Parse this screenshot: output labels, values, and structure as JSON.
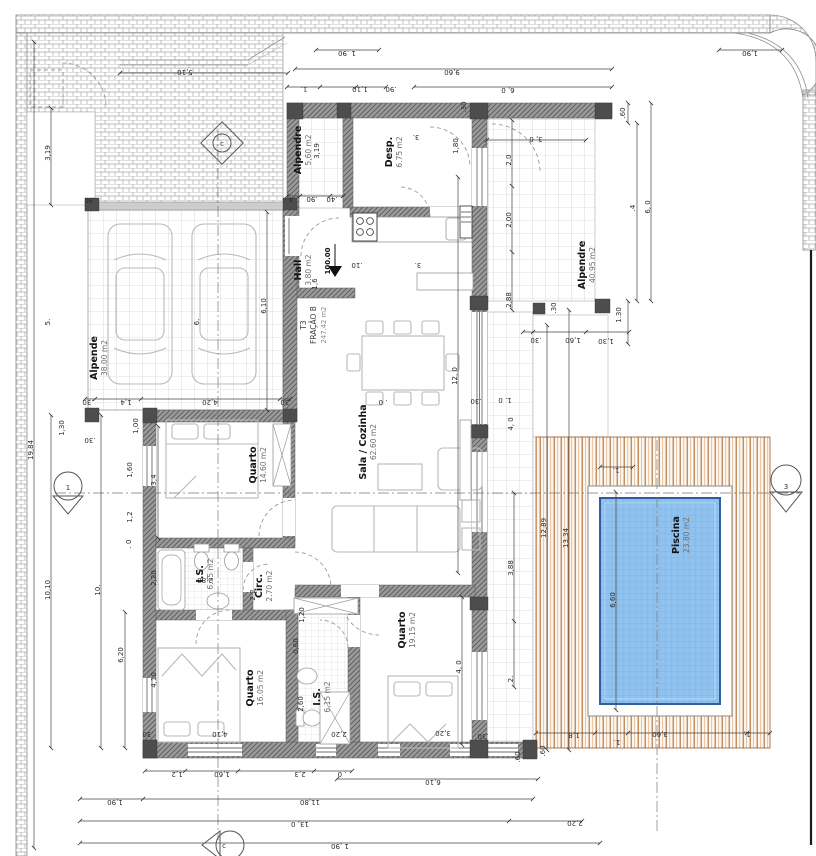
{
  "drawing": {
    "fraction": {
      "line1": "T3",
      "line2": "FRAÇÃO B",
      "line3": "247.42 m2",
      "x": 306,
      "y": 325
    },
    "level_marker": {
      "t": "100.00",
      "x": 330,
      "y": 261
    },
    "colors": {
      "wall": "#9b9b9b",
      "column": "#4d4d4d",
      "deck_stripe": "#b06a33",
      "pool_water": "#8fc2ee",
      "pool_border": "#2f5d9e",
      "tile_line": "#c2c2c2",
      "brick_line": "#a8a8a8"
    }
  },
  "rooms": [
    {
      "name": "Alpende",
      "area": "38.00 m2",
      "x": 97,
      "y": 358,
      "r": -90
    },
    {
      "name": "Alpendre",
      "area": "5,60 m2",
      "x": 301,
      "y": 150,
      "r": -90
    },
    {
      "name": "Desp.",
      "area": "6.75 m2",
      "x": 392,
      "y": 152,
      "r": -90
    },
    {
      "name": "Hall",
      "area": "3.80 m2",
      "x": 301,
      "y": 270,
      "r": -90
    },
    {
      "name": "Sala / Cozinha",
      "area": "62.60 m2",
      "x": 366,
      "y": 442,
      "r": -90
    },
    {
      "name": "Quarto",
      "area": "14.60 m2",
      "x": 256,
      "y": 465,
      "r": -90
    },
    {
      "name": "I.S.",
      "area": "6.15 m2",
      "x": 203,
      "y": 574,
      "r": -90
    },
    {
      "name": "Circ.",
      "area": "2.70 m2",
      "x": 262,
      "y": 586,
      "r": -90
    },
    {
      "name": "Quarto",
      "area": "16.05 m2",
      "x": 253,
      "y": 688,
      "r": -90
    },
    {
      "name": "I.S.",
      "area": "6,15 m2",
      "x": 320,
      "y": 697,
      "r": -90
    },
    {
      "name": "Quarto",
      "area": "19.15 m2",
      "x": 405,
      "y": 630,
      "r": -90
    },
    {
      "name": "Alpendre",
      "area": "40.95 m2",
      "x": 585,
      "y": 265,
      "r": -90
    },
    {
      "name": "Piscina",
      "area": "23.80 m2",
      "x": 679,
      "y": 535,
      "r": -90
    }
  ],
  "marker_letters": [
    {
      "t": "c",
      "x": 222,
      "y": 146
    },
    {
      "t": "1",
      "x": 68,
      "y": 490
    },
    {
      "t": "3",
      "x": 786,
      "y": 489
    },
    {
      "t": "c",
      "x": 224,
      "y": 848
    }
  ],
  "dims": [
    {
      "t": "5,10",
      "x": 185,
      "y": 70,
      "r": 180
    },
    {
      "t": "1 .90",
      "x": 347,
      "y": 51,
      "r": 180
    },
    {
      "t": "1,90",
      "x": 750,
      "y": 51,
      "r": 180
    },
    {
      "t": "9,60",
      "x": 452,
      "y": 70,
      "r": 180
    },
    {
      "t": "6, 0",
      "x": 508,
      "y": 88,
      "r": 180
    },
    {
      "t": "1.",
      "x": 304,
      "y": 87,
      "r": 180
    },
    {
      "t": "1,10",
      "x": 360,
      "y": 87,
      "r": 180
    },
    {
      "t": ".90",
      "x": 391,
      "y": 87,
      "r": 180
    },
    {
      "t": "19,84",
      "x": 33,
      "y": 450,
      "r": -90
    },
    {
      "t": "3,19",
      "x": 50,
      "y": 153,
      "r": -90
    },
    {
      "t": "5.",
      "x": 50,
      "y": 322,
      "r": -90
    },
    {
      "t": "6.",
      "x": 199,
      "y": 322,
      "r": -90
    },
    {
      "t": "10,10",
      "x": 50,
      "y": 590,
      "r": -90
    },
    {
      "t": "10.",
      "x": 100,
      "y": 590,
      "r": -90
    },
    {
      "t": "6,20",
      "x": 123,
      "y": 655,
      "r": -90
    },
    {
      "t": "1,30",
      "x": 64,
      "y": 428,
      "r": -90
    },
    {
      "t": "1,00",
      "x": 138,
      "y": 426,
      "r": -90
    },
    {
      "t": "1,60",
      "x": 132,
      "y": 470,
      "r": -90
    },
    {
      "t": "1,2",
      "x": 132,
      "y": 517,
      "r": -90
    },
    {
      "t": ". 0",
      "x": 131,
      "y": 544,
      "r": -90
    },
    {
      "t": "3,4",
      "x": 156,
      "y": 480,
      "r": -90
    },
    {
      "t": "2,20",
      "x": 156,
      "y": 578,
      "r": -90
    },
    {
      "t": "4,10",
      "x": 156,
      "y": 680,
      "r": -90
    },
    {
      "t": ".30",
      "x": 90,
      "y": 198,
      "r": 180
    },
    {
      "t": "6,10",
      "x": 266,
      "y": 306,
      "r": -90
    },
    {
      "t": ".30",
      "x": 88,
      "y": 400,
      "r": 180
    },
    {
      "t": "1,4",
      "x": 126,
      "y": 400,
      "r": 180
    },
    {
      "t": "4,20",
      "x": 210,
      "y": 400,
      "r": 180
    },
    {
      "t": ".30",
      "x": 286,
      "y": 400,
      "r": 180
    },
    {
      "t": ".30",
      "x": 90,
      "y": 438,
      "r": 180
    },
    {
      "t": ".4",
      "x": 292,
      "y": 197,
      "r": 180
    },
    {
      "t": ".90",
      "x": 312,
      "y": 197,
      "r": 180
    },
    {
      "t": ".40",
      "x": 332,
      "y": 197,
      "r": 180
    },
    {
      "t": "3,19",
      "x": 319,
      "y": 151,
      "r": -90
    },
    {
      "t": "1,80",
      "x": 458,
      "y": 146,
      "r": -90
    },
    {
      "t": "3.",
      "x": 416,
      "y": 135,
      "r": 180
    },
    {
      "t": "3.",
      "x": 418,
      "y": 263,
      "r": 180
    },
    {
      "t": ".10",
      "x": 357,
      "y": 263,
      "r": 180
    },
    {
      "t": "1,6",
      "x": 317,
      "y": 284,
      "r": -90
    },
    {
      "t": ".60",
      "x": 625,
      "y": 113,
      "r": -90
    },
    {
      "t": "3, 0",
      "x": 536,
      "y": 137,
      "r": 180
    },
    {
      "t": ".30",
      "x": 466,
      "y": 107,
      "r": -90
    },
    {
      "t": "2,0",
      "x": 511,
      "y": 160,
      "r": -90
    },
    {
      "t": "2,00",
      "x": 511,
      "y": 220,
      "r": -90
    },
    {
      "t": "2,88",
      "x": 511,
      "y": 300,
      "r": -90
    },
    {
      "t": ".4",
      "x": 635,
      "y": 208,
      "r": -90
    },
    {
      "t": "6, 0",
      "x": 650,
      "y": 207,
      "r": -90
    },
    {
      "t": "1.30",
      "x": 621,
      "y": 315,
      "r": -90
    },
    {
      "t": ".30",
      "x": 536,
      "y": 338,
      "r": 180
    },
    {
      "t": "1,60",
      "x": 573,
      "y": 338,
      "r": 180
    },
    {
      "t": "1,30",
      "x": 606,
      "y": 339,
      "r": 180
    },
    {
      "t": ".30",
      "x": 556,
      "y": 308,
      "r": -90
    },
    {
      "t": "12, 0",
      "x": 457,
      "y": 376,
      "r": -90
    },
    {
      "t": ". 0",
      "x": 383,
      "y": 400,
      "r": 180
    },
    {
      "t": ".30",
      "x": 476,
      "y": 399,
      "r": 180
    },
    {
      "t": "1. 0",
      "x": 505,
      "y": 398,
      "r": 180
    },
    {
      "t": "4, 0",
      "x": 513,
      "y": 424,
      "r": -90
    },
    {
      "t": "2,80",
      "x": 205,
      "y": 578,
      "r": 180
    },
    {
      "t": "1,20",
      "x": 304,
      "y": 615,
      "r": -90
    },
    {
      "t": "0,60",
      "x": 298,
      "y": 646,
      "r": -90
    },
    {
      "t": "2,2",
      "x": 255,
      "y": 595,
      "r": -90
    },
    {
      "t": "2,60",
      "x": 303,
      "y": 704,
      "r": -90
    },
    {
      "t": "2,20",
      "x": 339,
      "y": 732,
      "r": 180
    },
    {
      "t": "3,20",
      "x": 443,
      "y": 731,
      "r": 180
    },
    {
      "t": ".30",
      "x": 148,
      "y": 732,
      "r": 180
    },
    {
      "t": "4,10",
      "x": 220,
      "y": 732,
      "r": 180
    },
    {
      "t": ".30",
      "x": 483,
      "y": 734,
      "r": 180
    },
    {
      "t": "4, 0",
      "x": 461,
      "y": 667,
      "r": -90
    },
    {
      "t": "12,89",
      "x": 546,
      "y": 528,
      "r": -90
    },
    {
      "t": "13,34",
      "x": 568,
      "y": 538,
      "r": -90
    },
    {
      "t": "3,88",
      "x": 513,
      "y": 568,
      "r": -90
    },
    {
      "t": "6,60",
      "x": 615,
      "y": 600,
      "r": -90
    },
    {
      "t": "2.",
      "x": 513,
      "y": 679,
      "r": -90
    },
    {
      "t": "1.",
      "x": 616,
      "y": 468,
      "r": 180
    },
    {
      "t": ".60",
      "x": 520,
      "y": 757,
      "r": -90
    },
    {
      "t": ".60",
      "x": 545,
      "y": 751,
      "r": -90
    },
    {
      "t": "1,8",
      "x": 574,
      "y": 733,
      "r": 180
    },
    {
      "t": "1.",
      "x": 617,
      "y": 740,
      "r": 180
    },
    {
      "t": "3,60",
      "x": 660,
      "y": 732,
      "r": 180
    },
    {
      "t": "1,",
      "x": 747,
      "y": 732,
      "r": 180
    },
    {
      "t": "1,2",
      "x": 177,
      "y": 772,
      "r": 180
    },
    {
      "t": "1,60",
      "x": 222,
      "y": 772,
      "r": 180
    },
    {
      "t": "2,3",
      "x": 300,
      "y": 772,
      "r": 180
    },
    {
      "t": ". 0",
      "x": 342,
      "y": 772,
      "r": 180
    },
    {
      "t": "6,10",
      "x": 433,
      "y": 780,
      "r": 180
    },
    {
      "t": "1,90",
      "x": 115,
      "y": 800,
      "r": 180
    },
    {
      "t": "11,80",
      "x": 310,
      "y": 800,
      "r": 180
    },
    {
      "t": "13, 0",
      "x": 300,
      "y": 822,
      "r": 180
    },
    {
      "t": "2,20",
      "x": 575,
      "y": 821,
      "r": 180
    },
    {
      "t": "1 ,90",
      "x": 340,
      "y": 844,
      "r": 180
    }
  ]
}
